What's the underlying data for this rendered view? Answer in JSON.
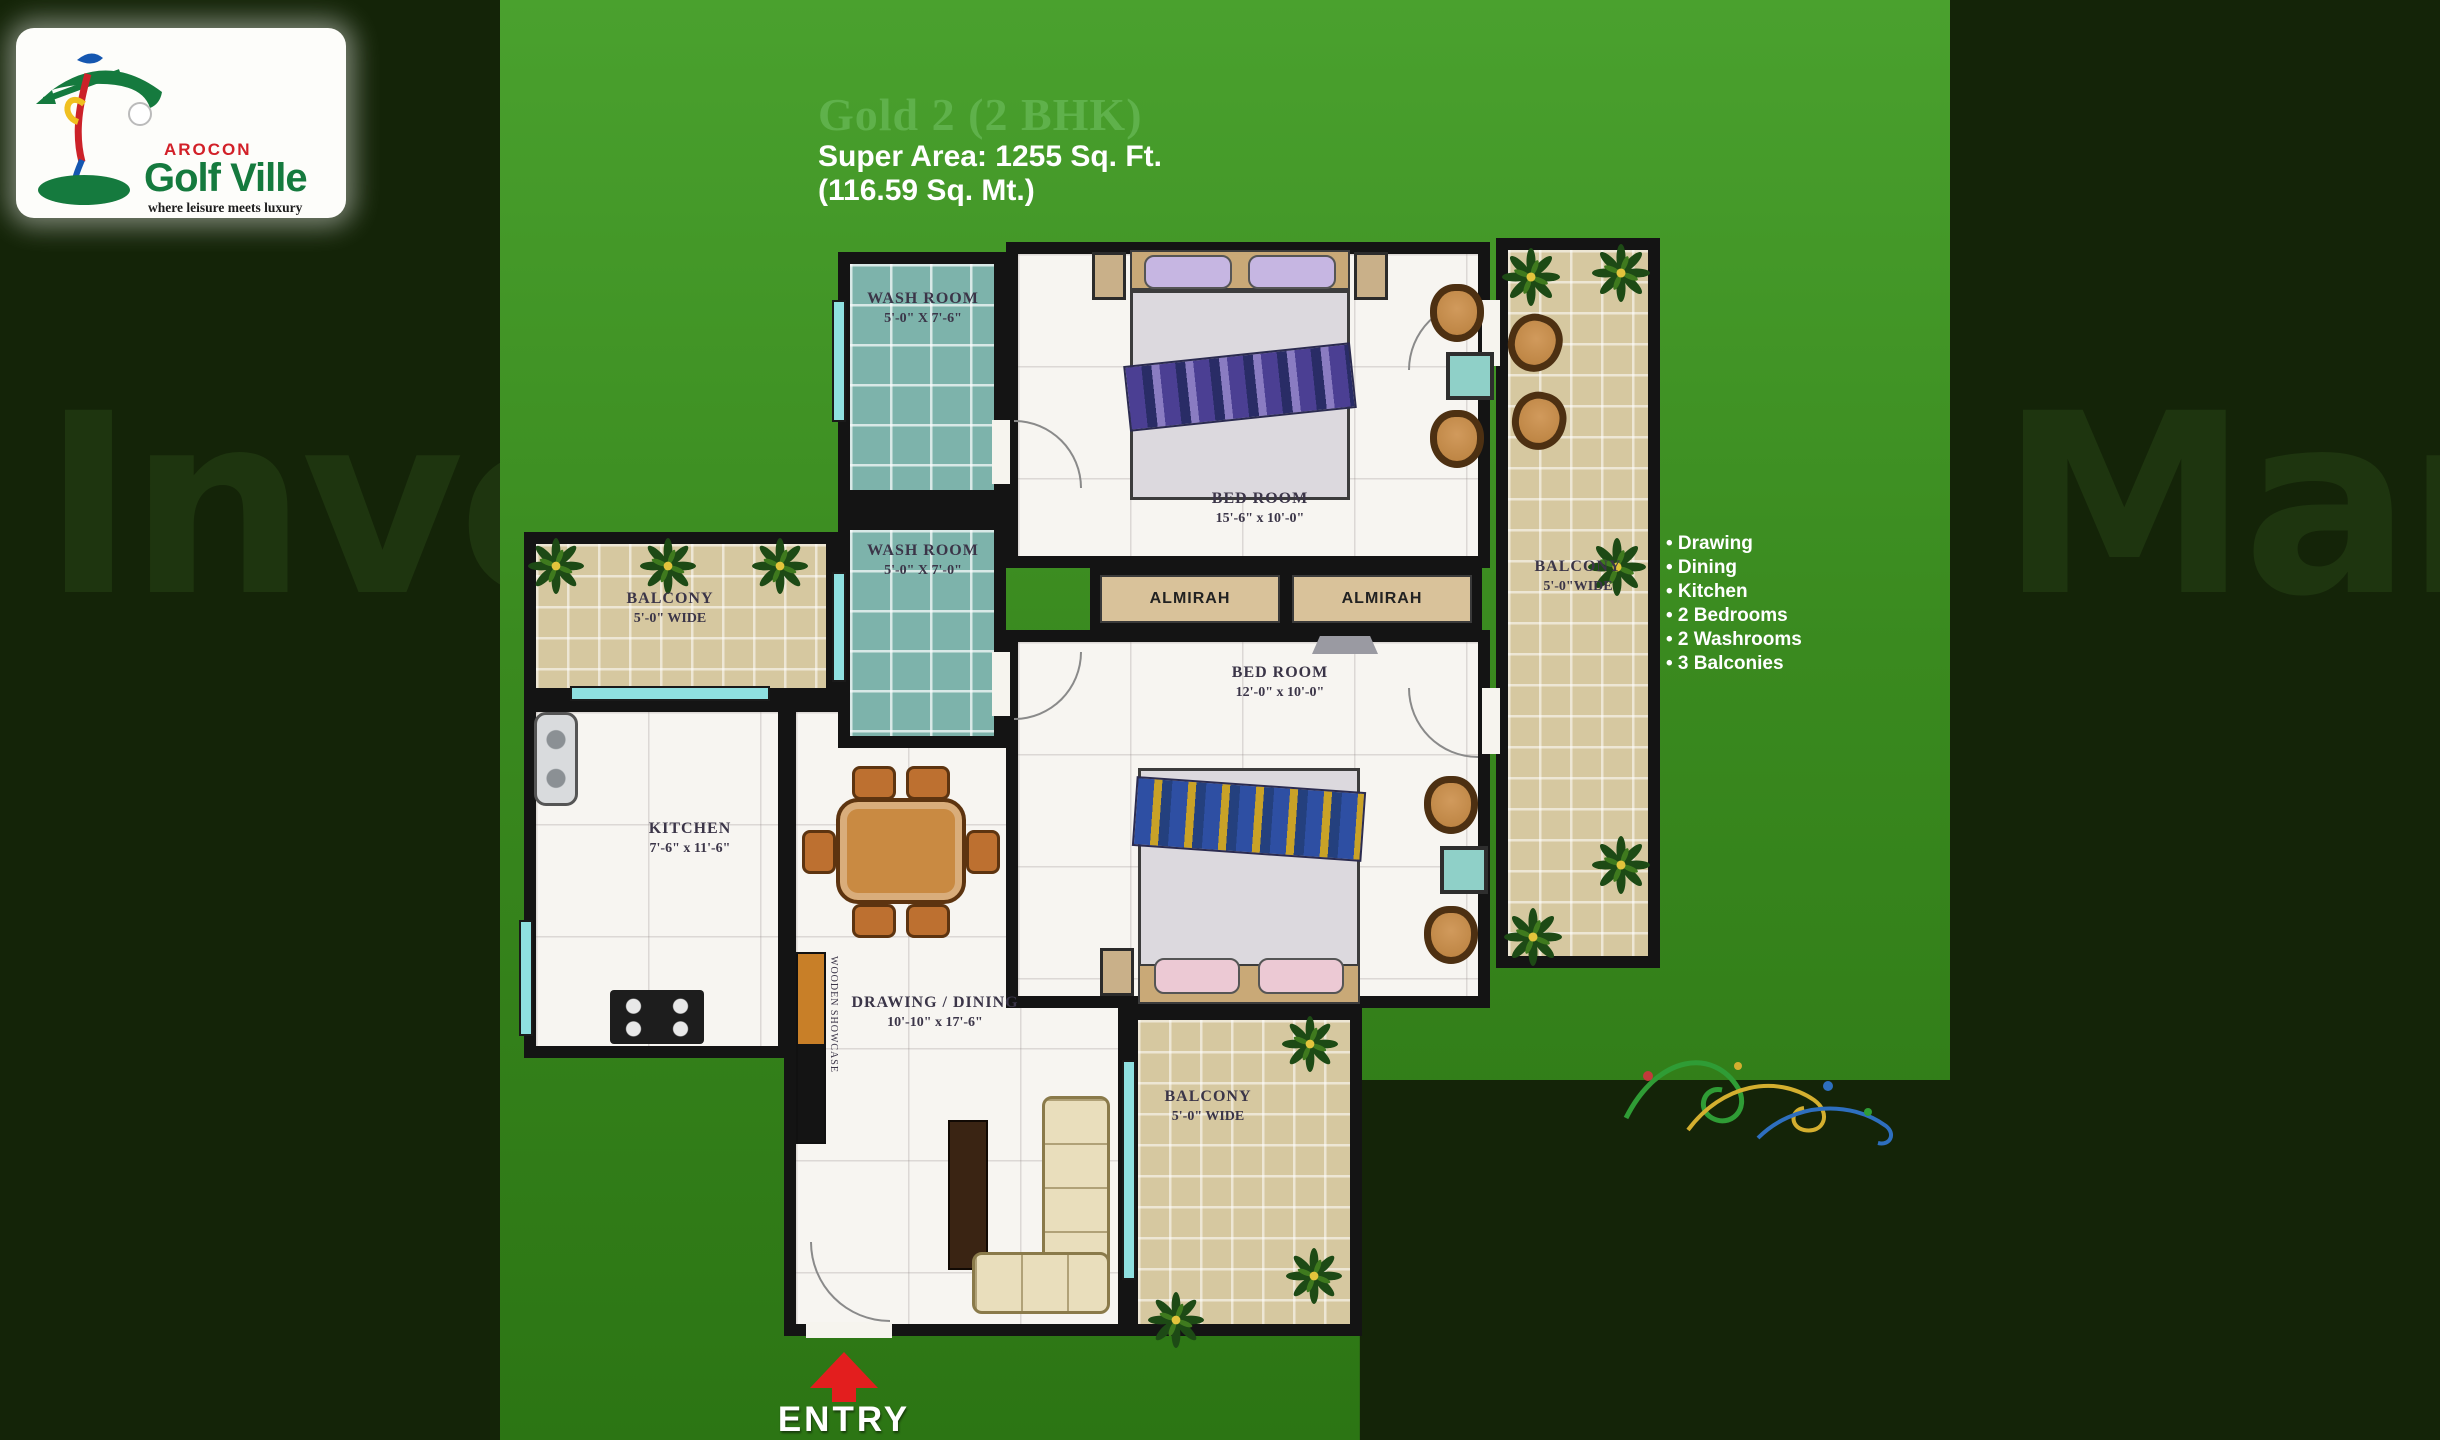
{
  "logo": {
    "brand": "AROCON",
    "name": "Golf Ville",
    "tagline": "where leisure meets luxury"
  },
  "header": {
    "plan_name": "Gold 2 (2 BHK)",
    "super_area": "Super Area: 1255 Sq. Ft.",
    "metric_area": "(116.59 Sq. Mt.)"
  },
  "features": {
    "items": [
      "• Drawing",
      "• Dining",
      "• Kitchen",
      "• 2 Bedrooms",
      "• 2 Washrooms",
      "• 3 Balconies"
    ]
  },
  "floorplan": {
    "washroom_top": {
      "name": "WASH ROOM",
      "dims": "5'-0\" X 7'-6\""
    },
    "washroom_bottom": {
      "name": "WASH ROOM",
      "dims": "5'-0\" X 7'-0\""
    },
    "bedroom_top": {
      "name": "BED ROOM",
      "dims": "15'-6\" x 10'-0\""
    },
    "bedroom_middle": {
      "name": "BED ROOM",
      "dims": "12'-0\" x 10'-0\""
    },
    "kitchen": {
      "name": "KITCHEN",
      "dims": "7'-6\" x 11'-6\""
    },
    "drawing_dining": {
      "name": "DRAWING / DINING",
      "dims": "10'-10\" x 17'-6\""
    },
    "balcony_left": {
      "name": "BALCONY",
      "dims": "5'-0\" WIDE"
    },
    "balcony_right": {
      "name": "BALCONY",
      "dims": "5'-0\"WIDE"
    },
    "balcony_bottom": {
      "name": "BALCONY",
      "dims": "5'-0\" WIDE"
    },
    "almirah_left": "ALMIRAH",
    "almirah_right": "ALMIRAH",
    "wooden_showcase": "WOODEN SHOWCASE",
    "entry_label": "ENTRY"
  },
  "watermark": {
    "left_fragment": "Inve",
    "right_fragment": "Mart"
  },
  "colors": {
    "background": "#142408",
    "panel_green_top": "#4aa12e",
    "panel_green_bottom": "#2c7514",
    "title_green": "#5fb14b",
    "entry_red": "#e31e1e",
    "balcony_tile": "#d6c8a0",
    "washroom_tile": "#7db3ab",
    "logo_green": "#157a3e",
    "logo_red": "#d22028"
  }
}
